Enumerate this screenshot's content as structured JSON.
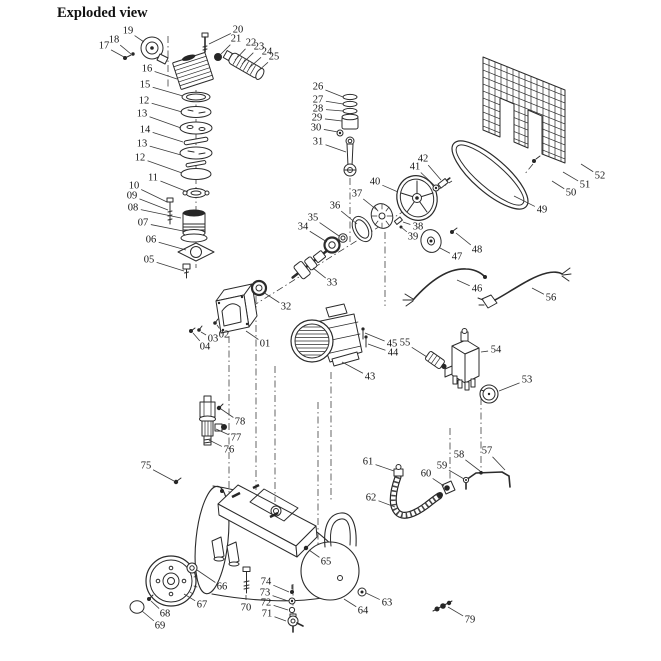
{
  "title": "Exploded view",
  "colors": {
    "ink": "#2b2b2b",
    "background": "#ffffff"
  },
  "diagram": {
    "type": "exploded-parts-diagram",
    "labels": [
      {
        "t": "01",
        "x": 265,
        "y": 344,
        "tx": 246,
        "ty": 331
      },
      {
        "t": "02",
        "x": 224,
        "y": 335,
        "tx": 217,
        "ty": 325
      },
      {
        "t": "03",
        "x": 213,
        "y": 339,
        "tx": 201,
        "ty": 332
      },
      {
        "t": "04",
        "x": 205,
        "y": 347,
        "tx": 193,
        "ty": 333
      },
      {
        "t": "05",
        "x": 149,
        "y": 260,
        "tx": 184,
        "ty": 271
      },
      {
        "t": "06",
        "x": 151,
        "y": 240,
        "tx": 186,
        "ty": 250
      },
      {
        "t": "07",
        "x": 143,
        "y": 223,
        "tx": 183,
        "ty": 231
      },
      {
        "t": "08",
        "x": 133,
        "y": 208,
        "tx": 181,
        "ty": 218
      },
      {
        "t": "09",
        "x": 132,
        "y": 196,
        "tx": 168,
        "ty": 210
      },
      {
        "t": "10",
        "x": 134,
        "y": 186,
        "tx": 167,
        "ty": 202
      },
      {
        "t": "11",
        "x": 153,
        "y": 178,
        "tx": 188,
        "ty": 192
      },
      {
        "t": "12",
        "x": 140,
        "y": 158,
        "tx": 182,
        "ty": 173
      },
      {
        "t": "13",
        "x": 142,
        "y": 144,
        "tx": 181,
        "ty": 155
      },
      {
        "t": "14",
        "x": 145,
        "y": 130,
        "tx": 183,
        "ty": 142
      },
      {
        "t": "13",
        "x": 142,
        "y": 114,
        "tx": 181,
        "ty": 128
      },
      {
        "t": "12",
        "x": 144,
        "y": 101,
        "tx": 182,
        "ty": 112
      },
      {
        "t": "15",
        "x": 145,
        "y": 85,
        "tx": 183,
        "ty": 96
      },
      {
        "t": "16",
        "x": 147,
        "y": 69,
        "tx": 177,
        "ty": 79
      },
      {
        "t": "17",
        "x": 104,
        "y": 46,
        "tx": 124,
        "ty": 57
      },
      {
        "t": "18",
        "x": 114,
        "y": 40,
        "tx": 131,
        "ty": 54
      },
      {
        "t": "19",
        "x": 128,
        "y": 31,
        "tx": 144,
        "ty": 42
      },
      {
        "t": "20",
        "x": 238,
        "y": 30,
        "tx": 209,
        "ty": 44
      },
      {
        "t": "21",
        "x": 236,
        "y": 39,
        "tx": 221,
        "ty": 54
      },
      {
        "t": "22",
        "x": 251,
        "y": 43,
        "tx": 235,
        "ty": 60
      },
      {
        "t": "23",
        "x": 259,
        "y": 47,
        "tx": 242,
        "ty": 64
      },
      {
        "t": "24",
        "x": 267,
        "y": 52,
        "tx": 249,
        "ty": 68
      },
      {
        "t": "25",
        "x": 274,
        "y": 57,
        "tx": 257,
        "ty": 72
      },
      {
        "t": "26",
        "x": 318,
        "y": 87,
        "tx": 343,
        "ty": 97
      },
      {
        "t": "27",
        "x": 318,
        "y": 100,
        "tx": 343,
        "ty": 104
      },
      {
        "t": "28",
        "x": 318,
        "y": 109,
        "tx": 343,
        "ty": 111
      },
      {
        "t": "29",
        "x": 317,
        "y": 118,
        "tx": 342,
        "ty": 121
      },
      {
        "t": "30",
        "x": 316,
        "y": 128,
        "tx": 338,
        "ty": 132
      },
      {
        "t": "31",
        "x": 318,
        "y": 142,
        "tx": 346,
        "ty": 152
      },
      {
        "t": "32",
        "x": 286,
        "y": 307,
        "tx": 263,
        "ty": 292
      },
      {
        "t": "33",
        "x": 332,
        "y": 283,
        "tx": 313,
        "ty": 268
      },
      {
        "t": "34",
        "x": 303,
        "y": 227,
        "tx": 327,
        "ty": 242
      },
      {
        "t": "35",
        "x": 313,
        "y": 218,
        "tx": 339,
        "ty": 236
      },
      {
        "t": "36",
        "x": 335,
        "y": 206,
        "tx": 357,
        "ty": 224
      },
      {
        "t": "37",
        "x": 357,
        "y": 194,
        "tx": 377,
        "ty": 210
      },
      {
        "t": "38",
        "x": 418,
        "y": 227,
        "tx": 403,
        "ty": 222
      },
      {
        "t": "39",
        "x": 413,
        "y": 237,
        "tx": 401,
        "ty": 227
      },
      {
        "t": "40",
        "x": 375,
        "y": 182,
        "tx": 398,
        "ty": 192
      },
      {
        "t": "41",
        "x": 415,
        "y": 167,
        "tx": 434,
        "ty": 185
      },
      {
        "t": "42",
        "x": 423,
        "y": 159,
        "tx": 441,
        "ty": 180
      },
      {
        "t": "43",
        "x": 370,
        "y": 377,
        "tx": 342,
        "ty": 362
      },
      {
        "t": "44",
        "x": 393,
        "y": 353,
        "tx": 368,
        "ty": 344
      },
      {
        "t": "45",
        "x": 392,
        "y": 344,
        "tx": 365,
        "ty": 333
      },
      {
        "t": "46",
        "x": 477,
        "y": 289,
        "tx": 457,
        "ty": 280
      },
      {
        "t": "47",
        "x": 457,
        "y": 257,
        "tx": 440,
        "ty": 248
      },
      {
        "t": "48",
        "x": 477,
        "y": 250,
        "tx": 456,
        "ty": 233
      },
      {
        "t": "49",
        "x": 542,
        "y": 210,
        "tx": 514,
        "ty": 196
      },
      {
        "t": "50",
        "x": 571,
        "y": 193,
        "tx": 552,
        "ty": 181
      },
      {
        "t": "51",
        "x": 585,
        "y": 185,
        "tx": 563,
        "ty": 172
      },
      {
        "t": "52",
        "x": 600,
        "y": 176,
        "tx": 581,
        "ty": 164
      },
      {
        "t": "53",
        "x": 527,
        "y": 380,
        "tx": 499,
        "ty": 391
      },
      {
        "t": "54",
        "x": 496,
        "y": 350,
        "tx": 481,
        "ty": 352
      },
      {
        "t": "55",
        "x": 405,
        "y": 343,
        "tx": 427,
        "ty": 357
      },
      {
        "t": "56",
        "x": 551,
        "y": 298,
        "tx": 532,
        "ty": 288
      },
      {
        "t": "57",
        "x": 487,
        "y": 451,
        "tx": 505,
        "ty": 470
      },
      {
        "t": "58",
        "x": 459,
        "y": 455,
        "tx": 480,
        "ty": 471
      },
      {
        "t": "59",
        "x": 442,
        "y": 466,
        "tx": 464,
        "ty": 479
      },
      {
        "t": "60",
        "x": 426,
        "y": 474,
        "tx": 444,
        "ty": 486
      },
      {
        "t": "61",
        "x": 368,
        "y": 462,
        "tx": 394,
        "ty": 471
      },
      {
        "t": "62",
        "x": 371,
        "y": 498,
        "tx": 395,
        "ty": 507
      },
      {
        "t": "63",
        "x": 387,
        "y": 603,
        "tx": 366,
        "ty": 593
      },
      {
        "t": "64",
        "x": 363,
        "y": 611,
        "tx": 344,
        "ty": 599
      },
      {
        "t": "65",
        "x": 326,
        "y": 562,
        "tx": 309,
        "ty": 550
      },
      {
        "t": "66",
        "x": 222,
        "y": 587,
        "tx": 197,
        "ty": 570
      },
      {
        "t": "67",
        "x": 202,
        "y": 605,
        "tx": 184,
        "ty": 594
      },
      {
        "t": "68",
        "x": 165,
        "y": 614,
        "tx": 151,
        "ty": 601
      },
      {
        "t": "69",
        "x": 160,
        "y": 626,
        "tx": 142,
        "ty": 611
      },
      {
        "t": "70",
        "x": 246,
        "y": 608,
        "tx": 246,
        "ty": 595
      },
      {
        "t": "71",
        "x": 267,
        "y": 614,
        "tx": 286,
        "ty": 621
      },
      {
        "t": "72",
        "x": 266,
        "y": 603,
        "tx": 288,
        "ty": 610
      },
      {
        "t": "73",
        "x": 265,
        "y": 593,
        "tx": 288,
        "ty": 601
      },
      {
        "t": "74",
        "x": 266,
        "y": 582,
        "tx": 289,
        "ty": 592
      },
      {
        "t": "75",
        "x": 146,
        "y": 466,
        "tx": 174,
        "ty": 481
      },
      {
        "t": "76",
        "x": 229,
        "y": 450,
        "tx": 209,
        "ty": 440
      },
      {
        "t": "77",
        "x": 236,
        "y": 438,
        "tx": 216,
        "ty": 429
      },
      {
        "t": "78",
        "x": 240,
        "y": 422,
        "tx": 221,
        "ty": 409
      },
      {
        "t": "79",
        "x": 470,
        "y": 620,
        "tx": 448,
        "ty": 607
      }
    ]
  }
}
